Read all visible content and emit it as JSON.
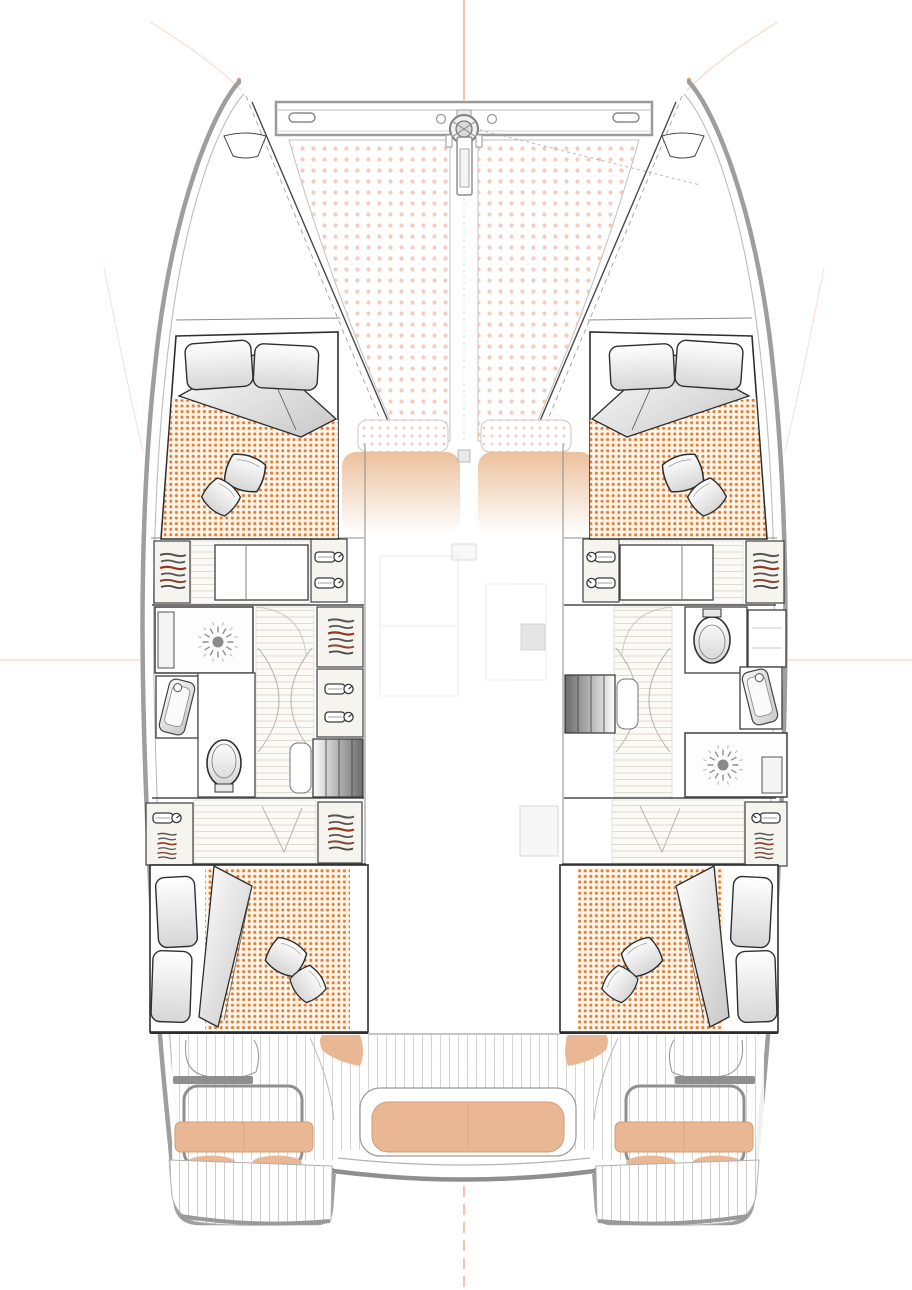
{
  "palette": {
    "background": "#ffffff",
    "hull_outline": "#9e9e9e",
    "line_dark": "#2e2e2e",
    "trampoline_dot": "#f3c2b0",
    "mattress_dot": "#e07c35",
    "mattress_bg": "#fdf3e6",
    "cushion_tan": "#eab795",
    "cushion_edge": "#d19d72",
    "seat_gradient_top": "#ecc09c",
    "wood_line": "#d8d1c2",
    "plank_line": "#c8c8c3",
    "stair_dark": "#6a6a6a",
    "guide_salmon": "#e59b80",
    "guide_peach": "#f3cab6"
  },
  "legend": {
    "icons": [
      "windlass-icon",
      "cleat-icon",
      "hanger-icon",
      "clothes-stack-icon",
      "showerhead-icon",
      "toilet-icon",
      "sink-icon",
      "stairs-icon",
      "pillow-icon",
      "throw-pillow-icon",
      "bench-cushion-icon"
    ]
  },
  "vessel": {
    "hulls": 2,
    "trampoline_panels": 2,
    "crossbeam_cleats": 2,
    "cabins": [
      {
        "id": "forward-port",
        "bed": "double",
        "pillows": 2,
        "throw_pillows": 2
      },
      {
        "id": "forward-starboard",
        "bed": "double",
        "pillows": 2,
        "throw_pillows": 2
      },
      {
        "id": "aft-port",
        "bed": "double",
        "pillows": 2,
        "throw_pillows": 2
      },
      {
        "id": "aft-starboard",
        "bed": "double",
        "pillows": 2,
        "throw_pillows": 2
      }
    ],
    "bathrooms": [
      {
        "id": "port",
        "fixtures": [
          "shower",
          "sink",
          "toilet"
        ]
      },
      {
        "id": "starboard",
        "fixtures": [
          "toilet",
          "sink",
          "shower"
        ]
      }
    ],
    "wardrobes": {
      "hanging_lockers": 5,
      "shelf_lockers": 6
    },
    "companionway_stairs": 2,
    "foredeck": {
      "lounge_seat_sections": 2,
      "sun_pads": 2
    },
    "cockpit": {
      "center_bench": true,
      "transom_seats": 2,
      "seat_ottomans": 4
    }
  }
}
